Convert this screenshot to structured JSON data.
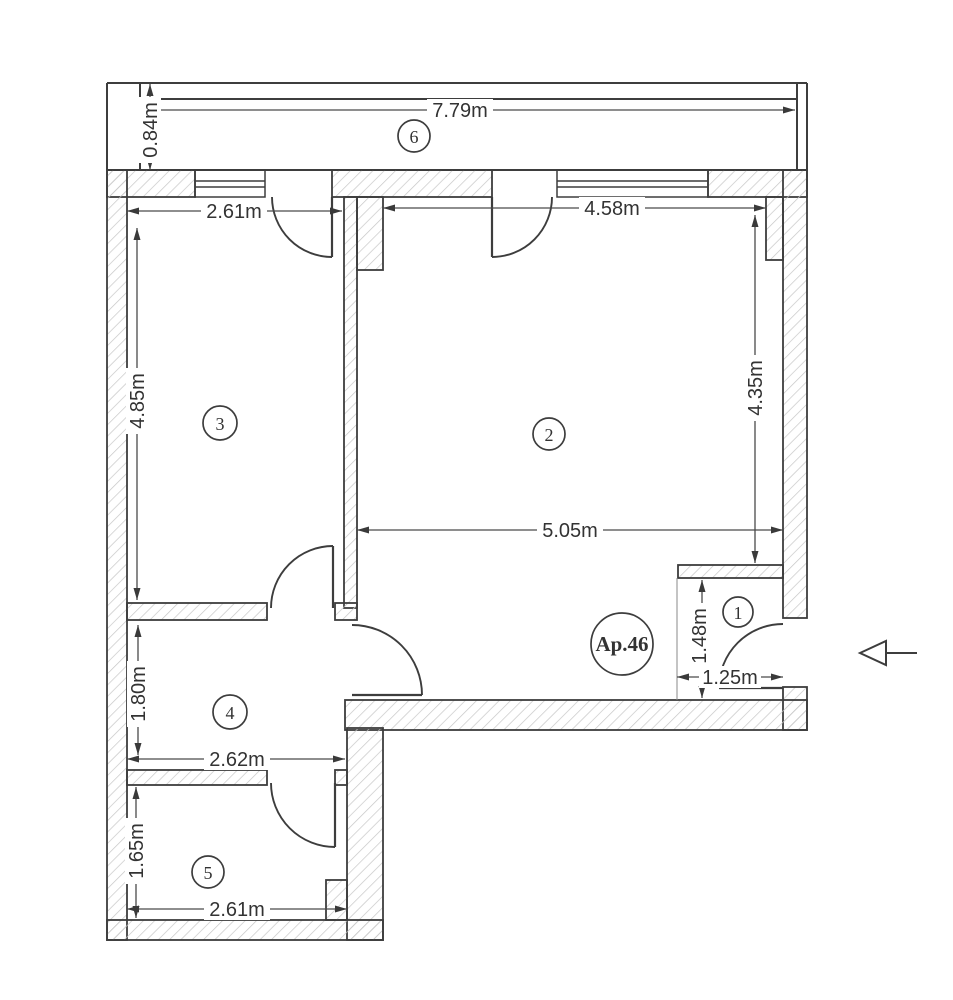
{
  "apartment": {
    "label": "Ap.46"
  },
  "rooms": [
    {
      "number": "1"
    },
    {
      "number": "2"
    },
    {
      "number": "3"
    },
    {
      "number": "4"
    },
    {
      "number": "5"
    },
    {
      "number": "6"
    }
  ],
  "dimensions": {
    "balcony_width": "7.79m",
    "balcony_depth": "0.84m",
    "room3_width": "2.61m",
    "room3_length": "4.85m",
    "room2_width": "4.58m",
    "room2_length": "4.35m",
    "room2_bottom_width": "5.05m",
    "entry_length": "1.48m",
    "entry_width": "1.25m",
    "room4_length": "1.80m",
    "room4_width": "2.62m",
    "room5_length": "1.65m",
    "room5_width": "2.61m"
  },
  "colors": {
    "line": "#3d3d3d",
    "hatch": "#c6c6c6",
    "background": "#ffffff"
  }
}
